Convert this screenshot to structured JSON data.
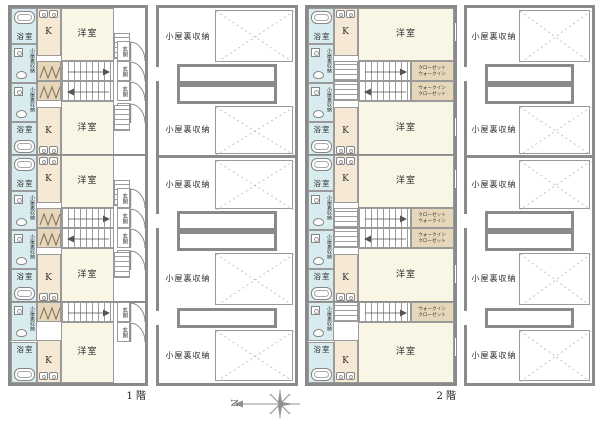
{
  "page": {
    "width": 600,
    "height": 424,
    "background": "#ffffff"
  },
  "labels": {
    "floor1": "1 階",
    "floor2": "2 階",
    "north": "N",
    "youshitsu": "洋室",
    "yokushitsu": "浴室",
    "kitchen": "K",
    "genkan": "玄関",
    "koyaura": "小屋裏収納",
    "koyaura_small": "小屋裏収納",
    "closet_line1": "クローゼット",
    "closet_line2": "ウォークイン"
  },
  "colors": {
    "wall": "#8a8a8a",
    "line": "#9a9a9a",
    "cream": "#faf6e6",
    "kitchen_fill": "#f5e9d6",
    "ladder_fill": "#e7d7ba",
    "wet": "#d8ecef",
    "text": "#2b2b2b",
    "void_line": "#b5b5b5"
  },
  "strips": [
    {
      "id": "floor-1-plan",
      "kind": "floor",
      "doors": true,
      "label_key": "floor1"
    },
    {
      "id": "attic-over-floor-1-plan",
      "kind": "attic"
    },
    {
      "id": "floor-2-plan",
      "kind": "floor",
      "doors": false,
      "label_key": "floor2"
    },
    {
      "id": "attic-over-floor-2-plan",
      "kind": "attic"
    }
  ]
}
